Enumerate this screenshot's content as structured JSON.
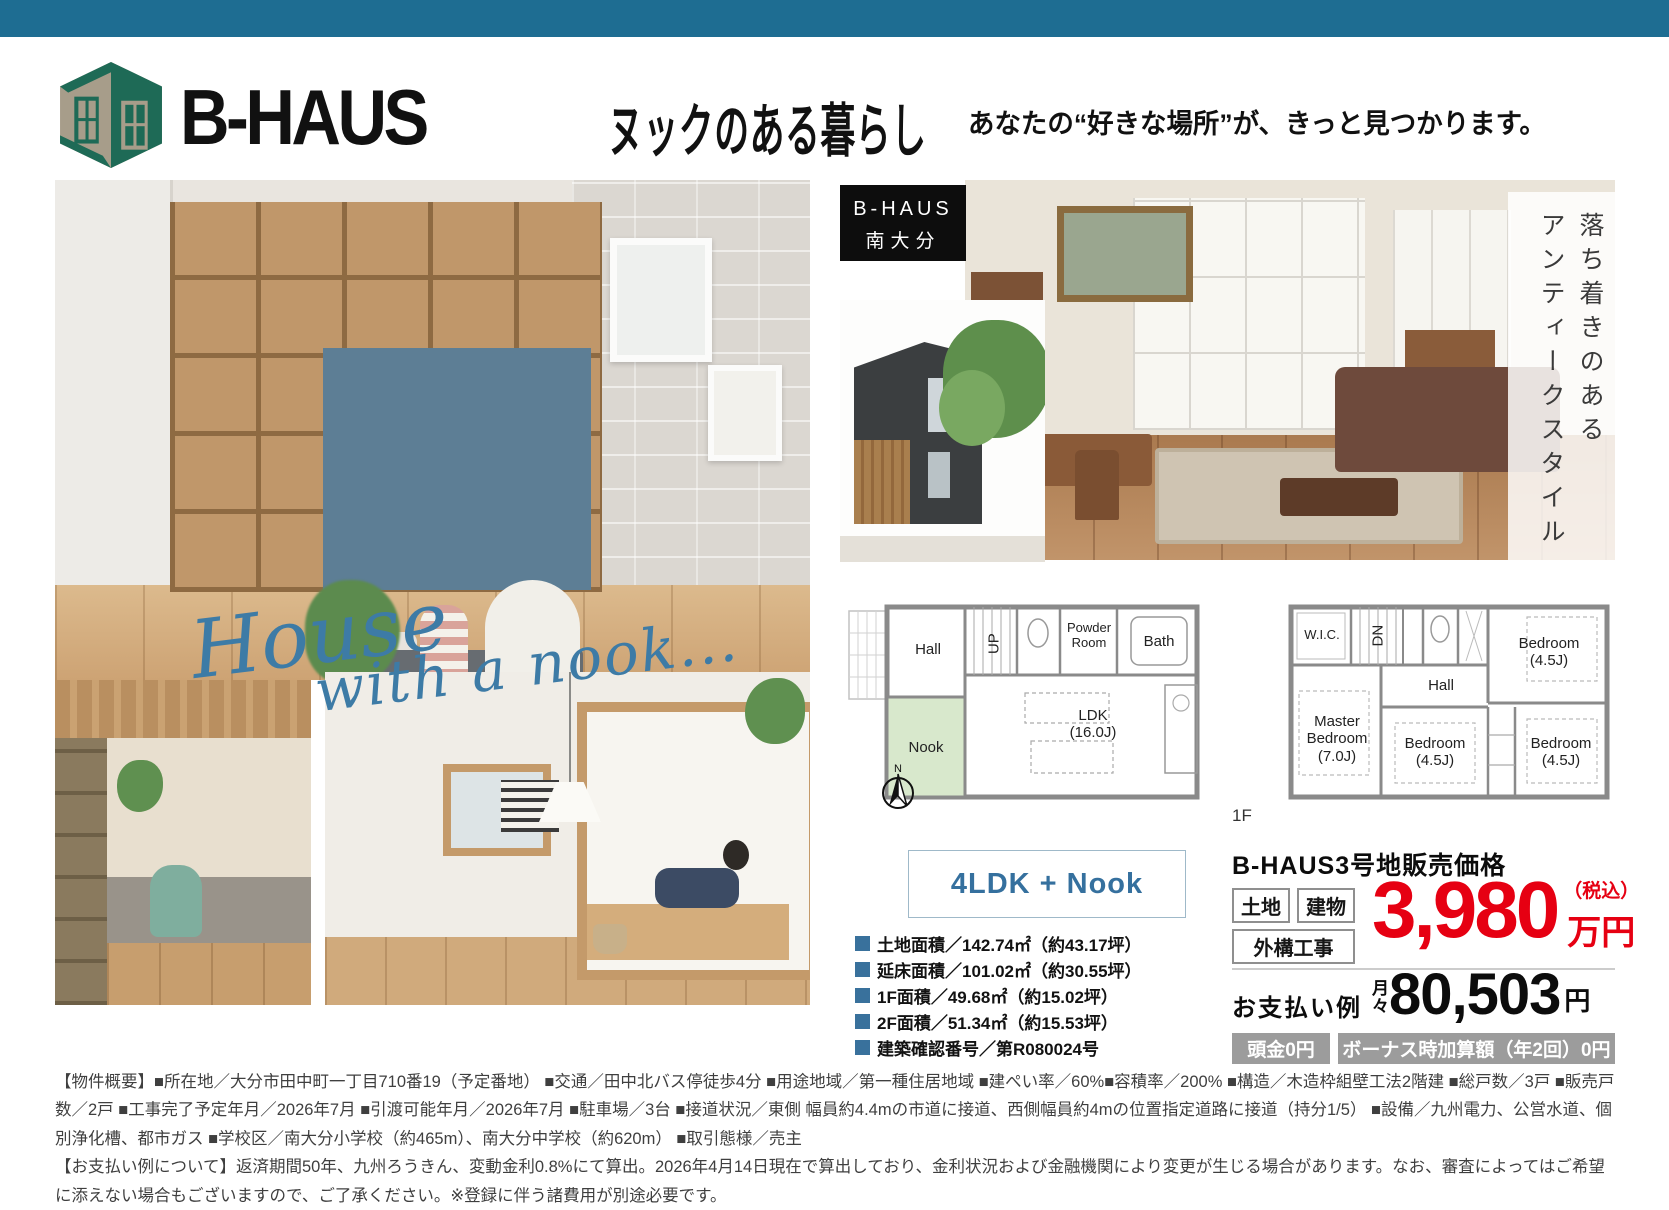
{
  "colors": {
    "topbar": "#1e6d92",
    "price_red": "#e60012",
    "accent_blue": "#39719c",
    "nook_green": "#d8e8cc",
    "logo_green": "#1e6a56",
    "logo_tan": "#a79d8a"
  },
  "header": {
    "brand": "B-HAUS",
    "title": "ヌックのある暮らし",
    "subtitle": "あなたの“好きな場所”が、きっと見つかります。"
  },
  "badges": {
    "location_line1": "B-HAUS",
    "location_line2": "南大分",
    "style_line1": "落ち着きのある",
    "style_line2": "アンティークスタイル"
  },
  "overlay": {
    "line1": "House",
    "line2": "with a nook..."
  },
  "floorplans": {
    "compass_label": "N",
    "f1": {
      "label": "1F",
      "rooms": {
        "hall": "Hall",
        "up": "UP",
        "powder": "Powder Room",
        "bath": "Bath",
        "nook": "Nook",
        "ldk": "LDK",
        "ldk_size": "(16.0J)"
      }
    },
    "f2": {
      "rooms": {
        "wic": "W.I.C.",
        "dn": "DN",
        "hall": "Hall",
        "bed1": "Bedroom",
        "bed1_size": "(4.5J)",
        "master1": "Master",
        "master2": "Bedroom",
        "master_size": "(7.0J)",
        "bed2": "Bedroom",
        "bed2_size": "(4.5J)",
        "bed3": "Bedroom",
        "bed3_size": "(4.5J)"
      }
    }
  },
  "plan_box": {
    "label": "4LDK + Nook"
  },
  "specs": {
    "items": [
      "土地面積／142.74㎡（約43.17坪）",
      "延床面積／101.02㎡（約30.55坪）",
      "1F面積／49.68㎡（約15.02坪）",
      "2F面積／51.34㎡（約15.53坪）",
      "建築確認番号／第R080024号"
    ]
  },
  "price": {
    "title": "B-HAUS3号地販売価格",
    "tag_land": "土地",
    "tag_building": "建物",
    "tag_exterior": "外構工事",
    "amount": "3,980",
    "tax_note": "（税込）",
    "unit": "万円",
    "payment_label": "お支払い例",
    "monthly_prefix1": "月",
    "monthly_prefix2": "々",
    "monthly_amount": "80,503",
    "monthly_unit": "円",
    "badge_down": "頭金0円",
    "badge_bonus": "ボーナス時加算額（年2回）0円"
  },
  "footer": {
    "overview": "【物件概要】■所在地／大分市田中町一丁目710番19（予定番地） ■交通／田中北バス停徒歩4分 ■用途地域／第一種住居地域 ■建ぺい率／60%■容積率／200% ■構造／木造枠組壁工法2階建 ■総戸数／3戸 ■販売戸数／2戸 ■工事完了予定年月／2026年7月 ■引渡可能年月／2026年7月 ■駐車場／3台 ■接道状況／東側 幅員約4.4mの市道に接道、西側幅員約4mの位置指定道路に接道（持分1/5） ■設備／九州電力、公営水道、個別浄化槽、都市ガス ■学校区／南大分小学校（約465m）、南大分中学校（約620m） ■取引態様／売主",
    "payment_note": "【お支払い例について】返済期間50年、九州ろうきん、変動金利0.8%にて算出。2026年4月14日現在で算出しており、金利状況および金融機関により変更が生じる場合があります。なお、審査によってはご希望に添えない場合もございますので、ご了承ください。※登録に伴う諸費用が別途必要です。"
  }
}
